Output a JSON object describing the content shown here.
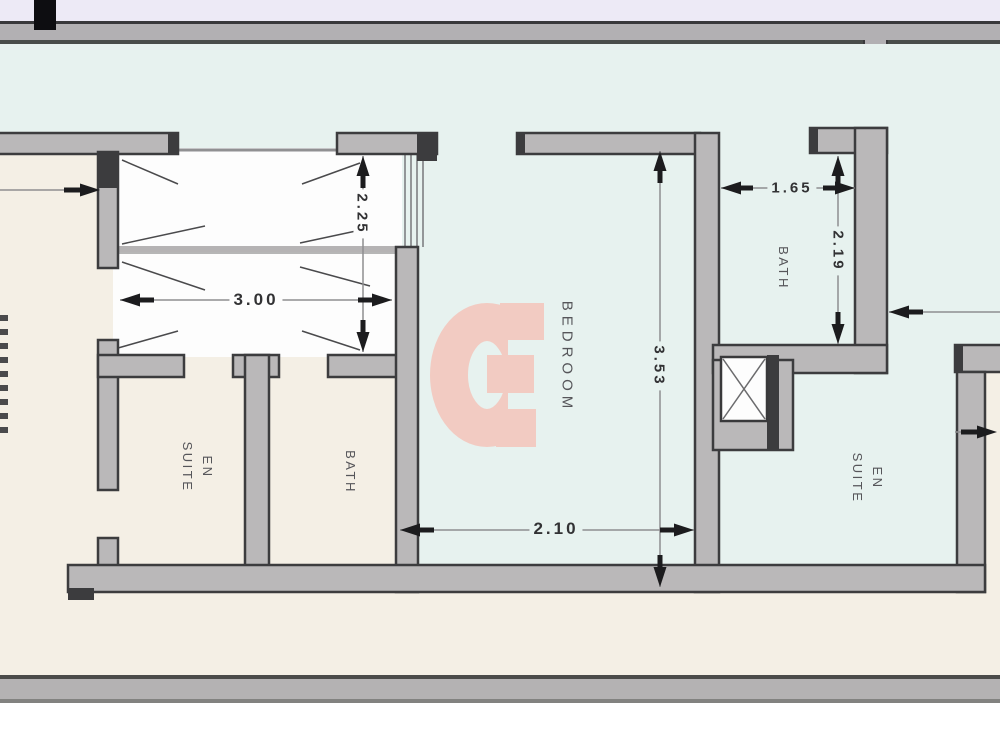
{
  "plan": {
    "rooms": {
      "en_suite_left": {
        "line1": "EN",
        "line2": "SUITE"
      },
      "bath_left": {
        "label": "BATH"
      },
      "bedroom": {
        "label": "BEDROOM"
      },
      "bath_right": {
        "label": "BATH"
      },
      "en_suite_right": {
        "line1": "EN",
        "line2": "SUITE"
      }
    },
    "dimensions": {
      "closet_width": "3.00",
      "closet_depth": "2.25",
      "bedroom_width": "2.10",
      "bedroom_length": "3.53",
      "bath_width": "1.65",
      "bath_length": "2.19"
    },
    "colors": {
      "watermark": "#f2cbc2",
      "terrace_floor": "#e7f2ef",
      "room_floor": "#f4efe5",
      "closet_floor": "#fdfdfd",
      "wall_fill": "#bab8b9",
      "wall_edge": "#3c3c3e",
      "banner_top": "#edeaf6",
      "banner_band": "#b2b0b3"
    }
  }
}
